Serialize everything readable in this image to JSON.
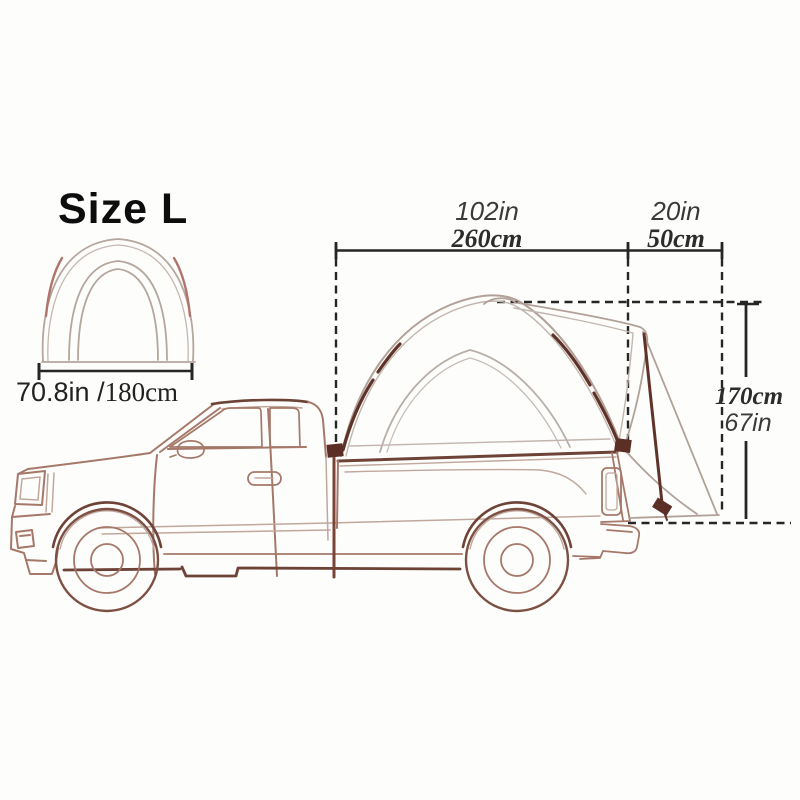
{
  "size_label": "Size L",
  "front_view": {
    "width_in": "70.8in /",
    "width_cm": "180cm"
  },
  "dims": {
    "bed_length_in": "102in",
    "bed_length_cm": "260cm",
    "overhang_in": "20in",
    "overhang_cm": "50cm",
    "height_cm": "170cm",
    "height_in": "67in"
  },
  "colors": {
    "ink": "#262626",
    "truck_outline": "#a5786a",
    "truck_light_detail": "#c0a89d",
    "dark_accent": "#6d4237",
    "strap_dark": "#5e3328",
    "tent_line": "#b2a198",
    "tent_inner_line": "#b8afa9",
    "pole_red": "#b0746a",
    "label_text": "#3a3a3a"
  }
}
